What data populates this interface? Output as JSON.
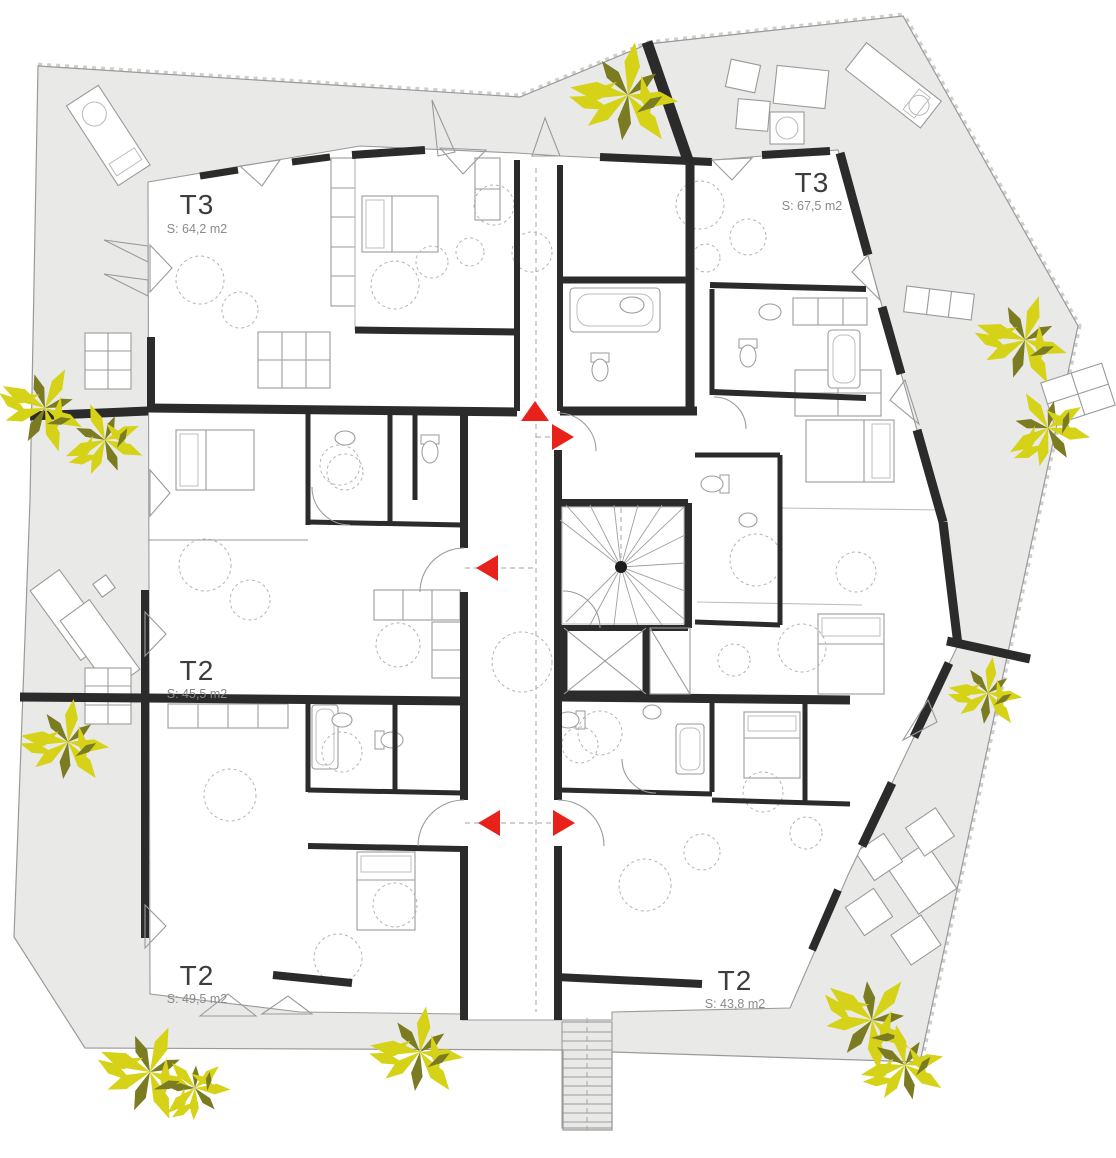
{
  "plan": {
    "apartments": [
      {
        "type": "T3",
        "area": "S: 64,2 m2"
      },
      {
        "type": "T3",
        "area": "S: 67,5 m2"
      },
      {
        "type": "T2",
        "area": "S: 45,5 m2"
      },
      {
        "type": "T2",
        "area": "S: 49,5 m2"
      },
      {
        "type": "T2",
        "area": "S: 43,8 m2"
      }
    ],
    "entrances": [
      {
        "name": "building-entrance",
        "direction": "up"
      },
      {
        "name": "apartment-t3-right-entrance",
        "direction": "right"
      },
      {
        "name": "apartment-t2-middle-left-entrance",
        "direction": "left"
      },
      {
        "name": "apartment-t2-bottom-left-entrance",
        "direction": "left"
      },
      {
        "name": "apartment-t2-bottom-right-entrance",
        "direction": "right"
      }
    ],
    "core": {
      "staircase": "winder-stair",
      "elevator": "crossed-shaft"
    }
  },
  "colors": {
    "terrace": "#e9e9e8",
    "building": "#ffffff",
    "wall": "#2b2b2b",
    "line": "#9a9a9a",
    "line-light": "#bdbdbd",
    "dash": "#b3b3b3",
    "arrow": "#e8211b",
    "plant-bright": "#d5d218",
    "plant-dark": "#7b7b22",
    "text": "#3d3d3d"
  }
}
